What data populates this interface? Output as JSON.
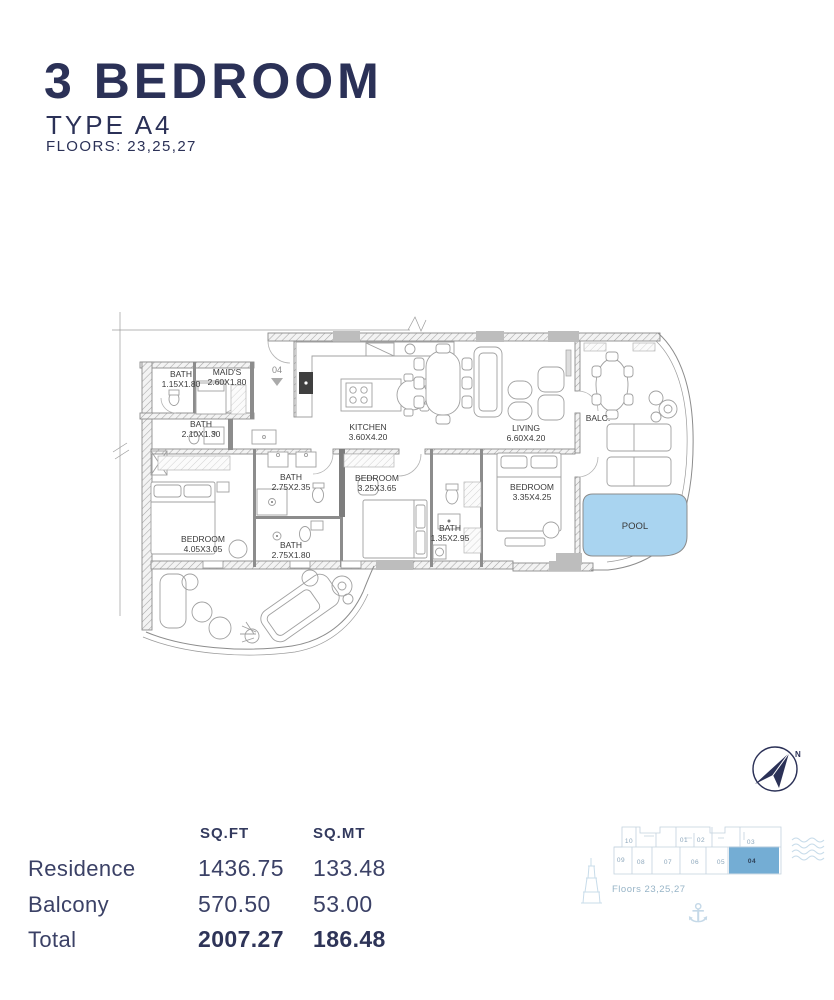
{
  "header": {
    "title": "3 BEDROOM",
    "type": "TYPE A4",
    "floors": "FLOORS: 23,25,27"
  },
  "plan": {
    "unit_marker": "04",
    "rooms": [
      {
        "name": "BATH",
        "dims": "1.15X1.80"
      },
      {
        "name": "MAID'S",
        "dims": "2.60X1.80"
      },
      {
        "name": "BATH",
        "dims": "2.10X1.30"
      },
      {
        "name": "KITCHEN",
        "dims": "3.60X4.20"
      },
      {
        "name": "LIVING",
        "dims": "6.60X4.20"
      },
      {
        "name": "BALC."
      },
      {
        "name": "BATH",
        "dims": "2.75X2.35"
      },
      {
        "name": "BEDROOM",
        "dims": "3.25X3.65"
      },
      {
        "name": "BEDROOM",
        "dims": "3.35X4.25"
      },
      {
        "name": "BATH",
        "dims": "1.35X2.95"
      },
      {
        "name": "BEDROOM",
        "dims": "4.05X3.05"
      },
      {
        "name": "BATH",
        "dims": "2.75X1.80"
      },
      {
        "name": "POOL"
      }
    ],
    "colors": {
      "pool_fill": "#a9d4f0",
      "line": "#8c8c8c",
      "label": "#3a3a3a"
    }
  },
  "areas": {
    "headers": {
      "sqft": "SQ.FT",
      "sqmt": "SQ.MT"
    },
    "rows": [
      {
        "label": "Residence",
        "sqft": "1436.75",
        "sqmt": "133.48"
      },
      {
        "label": "Balcony",
        "sqft": "570.50",
        "sqmt": "53.00"
      },
      {
        "label": "Total",
        "sqft": "2007.27",
        "sqmt": "186.48"
      }
    ]
  },
  "keyplan": {
    "floors": "Floors 23,25,27",
    "highlight": "04",
    "units_top": [
      {
        "label": "10"
      },
      {
        "label": "01"
      },
      {
        "label": "02"
      },
      {
        "label": "03"
      }
    ],
    "units_bottom": [
      {
        "label": "09"
      },
      {
        "label": "08"
      },
      {
        "label": "07"
      },
      {
        "label": "06"
      },
      {
        "label": "05"
      },
      {
        "label": "04"
      }
    ],
    "colors": {
      "highlight": "#74add4",
      "line": "#c3d2de",
      "text": "#8ba6bb"
    }
  },
  "compass": {
    "north": "N"
  }
}
